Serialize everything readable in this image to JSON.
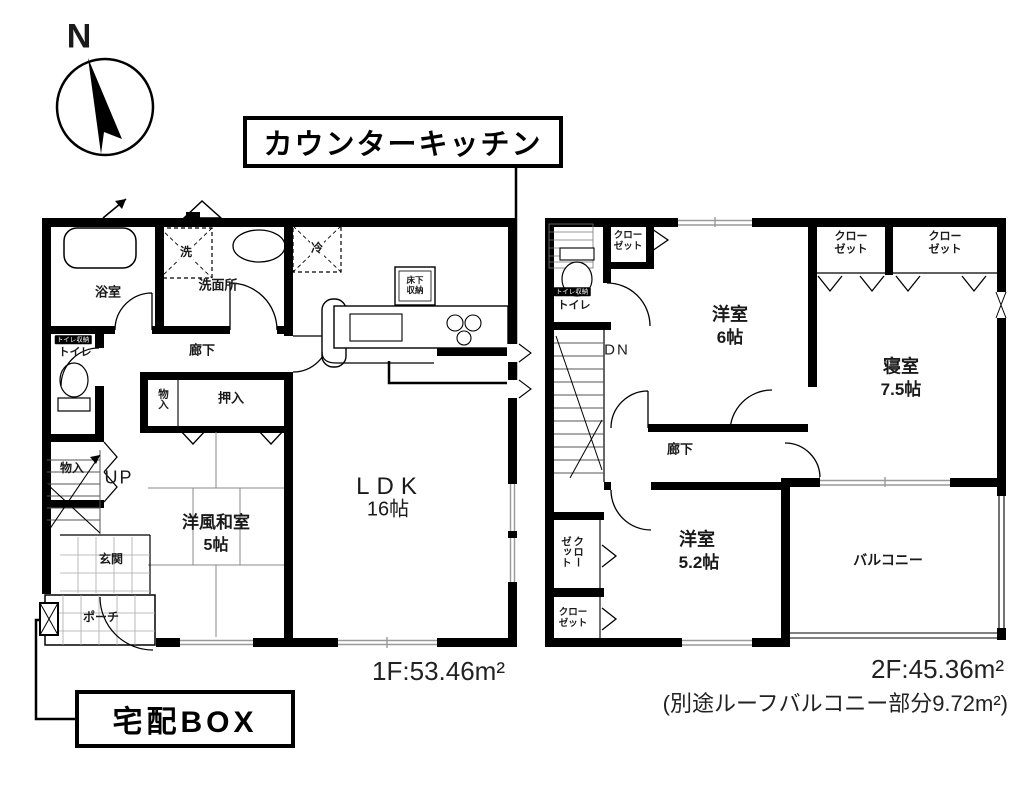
{
  "compass": {
    "north_label": "N"
  },
  "callouts": {
    "counter_kitchen": "カウンターキッチン",
    "delivery_box": "宅配BOX"
  },
  "floor1": {
    "area_label": "1F:53.46m²",
    "rooms": {
      "bath": "浴室",
      "washroom": "洗面所",
      "washer_symbol": "洗",
      "fridge_symbol": "冷",
      "underfloor_storage": "床下収納",
      "toilet_cabinet_tag": "トイレ収納",
      "toilet": "トイレ",
      "hallway": "廊下",
      "storage_left": "物入",
      "storage_small": "物入",
      "oshiire": "押入",
      "stairs": "UP",
      "japanese_room": "洋風和室",
      "japanese_room_size": "5帖",
      "entrance": "玄関",
      "porch": "ポーチ",
      "ldk": "LDK",
      "ldk_size": "16帖"
    }
  },
  "floor2": {
    "area_label": "2F:45.36m²",
    "area_note": "(別途ルーフバルコニー部分9.72m²)",
    "rooms": {
      "toilet_cabinet_tag": "トイレ収納",
      "toilet": "トイレ",
      "closet_by_toilet": "クローゼット",
      "stairs": "DN",
      "hallway": "廊下",
      "west_room_6": "洋室",
      "west_room_6_size": "6帖",
      "closet_bedroom_left": "クローゼット",
      "closet_bedroom_right": "クローゼット",
      "bedroom": "寝室",
      "bedroom_size": "7.5帖",
      "closet_mid_vertical": "クローゼット",
      "closet_bottom": "クローゼット",
      "west_room_52": "洋室",
      "west_room_52_size": "5.2帖",
      "balcony": "バルコニー"
    }
  }
}
